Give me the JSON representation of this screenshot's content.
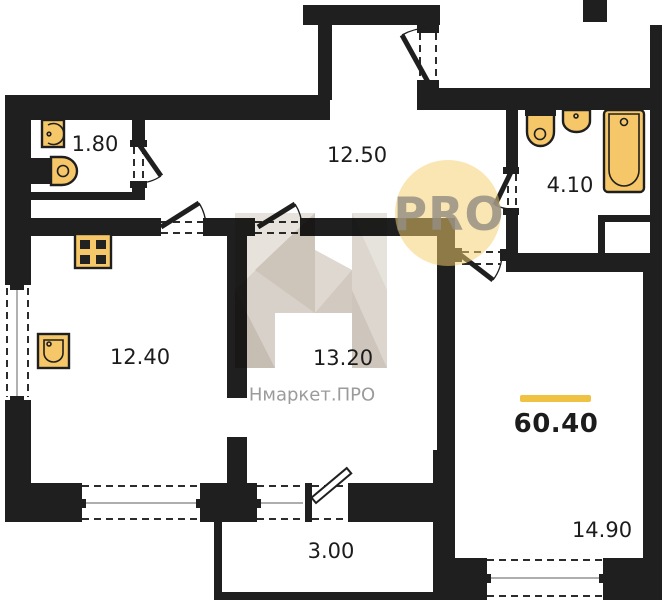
{
  "plan": {
    "rooms": [
      {
        "id": "wc",
        "area": "1.80"
      },
      {
        "id": "hallway",
        "area": "12.50"
      },
      {
        "id": "bathroom",
        "area": "4.10"
      },
      {
        "id": "kitchen",
        "area": "12.40"
      },
      {
        "id": "living-room",
        "area": "13.20"
      },
      {
        "id": "balcony",
        "area": "3.00"
      },
      {
        "id": "bedroom",
        "area": "14.90"
      }
    ],
    "total_area": "60.40"
  },
  "watermark": {
    "brand": "Нмаркет.ПРО",
    "badge": "PRO"
  },
  "colors": {
    "wall": "#1f1f1f",
    "fixture_fill": "#f6c768",
    "accent": "#efc243",
    "watermark_circle": "#f5cf6e",
    "brand_text": "#9b9b9b"
  }
}
